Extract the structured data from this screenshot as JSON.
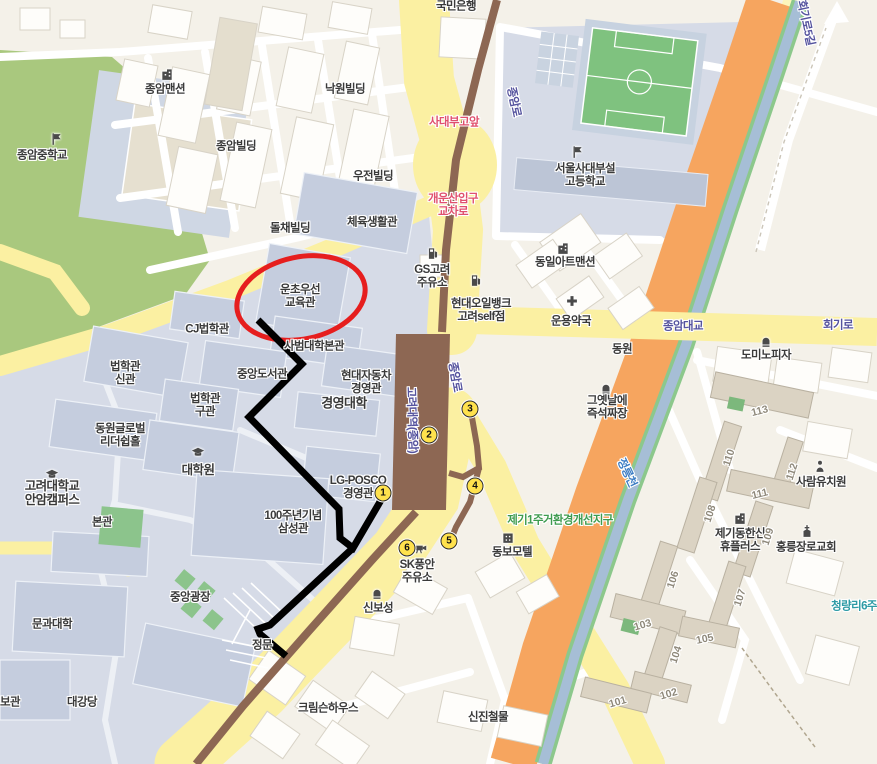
{
  "map": {
    "poi_labels": [
      {
        "text": "국민은행",
        "x": 456,
        "y": 7
      },
      {
        "text": "종암맨션",
        "x": 165,
        "y": 90,
        "icon": "building",
        "ix": 167,
        "iy": 74
      },
      {
        "text": "낙원빌딩",
        "x": 345,
        "y": 90
      },
      {
        "text": "종암중학교",
        "x": 42,
        "y": 156,
        "icon": "flag",
        "ix": 56,
        "iy": 139
      },
      {
        "text": "종암빌딩",
        "x": 236,
        "y": 147
      },
      {
        "text": "우전빌딩",
        "x": 373,
        "y": 177
      },
      {
        "text": "돌채빌딩",
        "x": 290,
        "y": 229
      },
      {
        "text": "체육생활관",
        "x": 372,
        "y": 223
      },
      {
        "text": "서울사대부설\n고등학교",
        "x": 585,
        "y": 176,
        "icon": "flag",
        "ix": 577,
        "iy": 152
      },
      {
        "text": "GS고려\n주유소",
        "x": 432,
        "y": 277,
        "icon": "gas",
        "ix": 433,
        "iy": 253
      },
      {
        "text": "동일아트맨션",
        "x": 565,
        "y": 263,
        "icon": "building",
        "ix": 563,
        "iy": 248
      },
      {
        "text": "현대오일뱅크\n고려self점",
        "x": 481,
        "y": 311,
        "icon": "gas",
        "ix": 476,
        "iy": 280
      },
      {
        "text": "운용약국",
        "x": 571,
        "y": 322,
        "icon": "cross",
        "ix": 572,
        "iy": 301
      },
      {
        "text": "동원",
        "x": 622,
        "y": 350
      },
      {
        "text": "운초우선\n교육관",
        "x": 300,
        "y": 297
      },
      {
        "text": "CJ법학관",
        "x": 207,
        "y": 330
      },
      {
        "text": "사범대학본관",
        "x": 314,
        "y": 347
      },
      {
        "text": "중앙도서관",
        "x": 262,
        "y": 375
      },
      {
        "text": "현대자동차\n경영관",
        "x": 366,
        "y": 383
      },
      {
        "text": "경영대학",
        "x": 344,
        "y": 404,
        "size": 13
      },
      {
        "text": "법학관\n신관",
        "x": 125,
        "y": 374
      },
      {
        "text": "법학관\n구관",
        "x": 205,
        "y": 406
      },
      {
        "text": "동원글로벌\n리더쉽홀",
        "x": 120,
        "y": 436
      },
      {
        "text": "대학원",
        "x": 198,
        "y": 470,
        "size": 12.5,
        "icon": "cap",
        "ix": 198,
        "iy": 453
      },
      {
        "text": "고려대학교\n안암캠퍼스",
        "x": 52,
        "y": 493,
        "size": 12.5,
        "icon": "cap",
        "ix": 52,
        "iy": 475
      },
      {
        "text": "본관",
        "x": 102,
        "y": 523
      },
      {
        "text": "100주년기념\n삼성관",
        "x": 293,
        "y": 523
      },
      {
        "text": "LG-POSCO\n경영관",
        "x": 358,
        "y": 488
      },
      {
        "text": "그옛날에\n즉석짜장",
        "x": 607,
        "y": 408,
        "icon": "food",
        "ix": 606,
        "iy": 388
      },
      {
        "text": "도미노피자",
        "x": 766,
        "y": 356,
        "icon": "food",
        "ix": 766,
        "iy": 341
      },
      {
        "text": "동보모텔",
        "x": 512,
        "y": 553,
        "icon": "motel",
        "ix": 508,
        "iy": 537
      },
      {
        "text": "SK풍안\n주유소",
        "x": 417,
        "y": 572
      },
      {
        "text": "신보성",
        "x": 378,
        "y": 609,
        "icon": "food",
        "ix": 377,
        "iy": 593
      },
      {
        "text": "사람유치원",
        "x": 821,
        "y": 483,
        "icon": "person",
        "ix": 820,
        "iy": 466
      },
      {
        "text": "제기동한신\n휴플러스",
        "x": 740,
        "y": 541,
        "icon": "building",
        "ix": 740,
        "iy": 518
      },
      {
        "text": "홍릉장로교회",
        "x": 806,
        "y": 548,
        "icon": "church",
        "ix": 807,
        "iy": 531
      },
      {
        "text": "크림슨하우스",
        "x": 328,
        "y": 709
      },
      {
        "text": "신진철물",
        "x": 488,
        "y": 718
      },
      {
        "text": "문과대학",
        "x": 52,
        "y": 625
      },
      {
        "text": "중앙광장",
        "x": 190,
        "y": 598
      },
      {
        "text": "대강당",
        "x": 82,
        "y": 703
      },
      {
        "text": "보관",
        "x": 10,
        "y": 703
      },
      {
        "text": "정문",
        "x": 262,
        "y": 646
      },
      {
        "text": "",
        "icon": "camera",
        "ix": 421,
        "iy": 548
      }
    ],
    "road_labels": [
      {
        "text": "회기로5길",
        "x": 805,
        "y": 23,
        "rot": 78,
        "style": "road"
      },
      {
        "text": "종암로",
        "x": 513,
        "y": 102,
        "rot": 78,
        "style": "road"
      },
      {
        "text": "사대부고앞",
        "x": 454,
        "y": 123,
        "rot": 0,
        "style": "pink"
      },
      {
        "text": "개운산입구\n교차로",
        "x": 453,
        "y": 206,
        "rot": 0,
        "style": "pink"
      },
      {
        "text": "종암대교",
        "x": 683,
        "y": 327,
        "rot": 0,
        "style": "road"
      },
      {
        "text": "회기로",
        "x": 838,
        "y": 326,
        "rot": 0,
        "style": "road"
      },
      {
        "text": "종암로",
        "x": 454,
        "y": 377,
        "rot": 80,
        "style": "road"
      },
      {
        "text": "고려대역(종암)",
        "x": 411,
        "y": 420,
        "rot": 88,
        "style": "road"
      },
      {
        "text": "정릉천",
        "x": 626,
        "y": 473,
        "rot": 65,
        "style": "blue"
      },
      {
        "text": "제기1주거환경개선지구",
        "x": 560,
        "y": 521,
        "rot": 0,
        "style": "green"
      },
      {
        "text": "청량리6주",
        "x": 854,
        "y": 607,
        "rot": 0,
        "style": "teal"
      }
    ],
    "building_numbers": [
      {
        "text": "113",
        "x": 760,
        "y": 412,
        "rot": -14
      },
      {
        "text": "110",
        "x": 730,
        "y": 458,
        "rot": -72
      },
      {
        "text": "112",
        "x": 793,
        "y": 472,
        "rot": -72
      },
      {
        "text": "111",
        "x": 760,
        "y": 495,
        "rot": -14
      },
      {
        "text": "108",
        "x": 711,
        "y": 514,
        "rot": -72
      },
      {
        "text": "109",
        "x": 769,
        "y": 537,
        "rot": -72
      },
      {
        "text": "106",
        "x": 674,
        "y": 580,
        "rot": -72
      },
      {
        "text": "107",
        "x": 741,
        "y": 598,
        "rot": -72
      },
      {
        "text": "103",
        "x": 643,
        "y": 626,
        "rot": -16
      },
      {
        "text": "105",
        "x": 705,
        "y": 640,
        "rot": -12
      },
      {
        "text": "104",
        "x": 677,
        "y": 655,
        "rot": -72
      },
      {
        "text": "102",
        "x": 669,
        "y": 695,
        "rot": -16
      },
      {
        "text": "101",
        "x": 618,
        "y": 703,
        "rot": -16
      }
    ],
    "subway_exits": [
      {
        "number": "1",
        "x": 383,
        "y": 493
      },
      {
        "number": "2",
        "x": 429,
        "y": 435
      },
      {
        "number": "3",
        "x": 470,
        "y": 409
      },
      {
        "number": "4",
        "x": 475,
        "y": 486
      },
      {
        "number": "5",
        "x": 449,
        "y": 541
      },
      {
        "number": "6",
        "x": 407,
        "y": 548
      }
    ],
    "annotations": {
      "highlight": {
        "color": "#E61E1E",
        "cx": 301,
        "cy": 298,
        "rx": 65,
        "ry": 41,
        "rot": -12
      },
      "route": {
        "color": "#000000",
        "segments": [
          "258,320 302,364 249,417 339,509 340,538 353,548 384,495",
          "353,548 270,625 258,629 260,634 286,656"
        ]
      }
    }
  }
}
